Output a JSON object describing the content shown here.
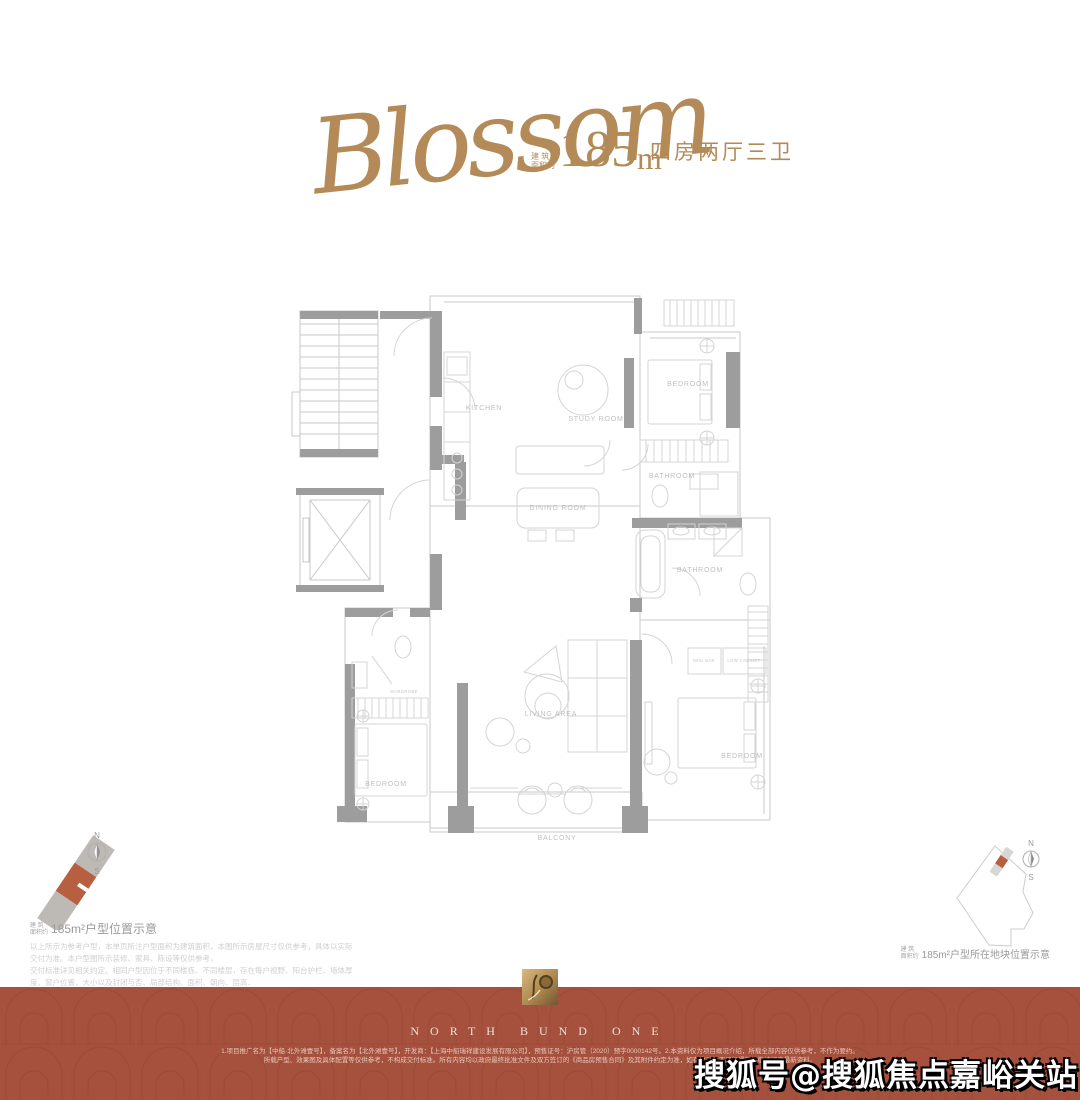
{
  "colors": {
    "gold": "#b28a55",
    "banner_red": "#a5513d",
    "terracotta": "#b65f41",
    "plan_wall": "#9d9d9d",
    "plan_line": "#c9c9c9",
    "label_gray": "#bfbfbf"
  },
  "header": {
    "script_name": "Blossom",
    "area_prefix_top": "建 筑",
    "area_prefix_bottom": "面积约",
    "area_value": "185",
    "area_unit": "m",
    "area_exponent": "2",
    "layout_text": "四房两厅三卫"
  },
  "floorplan": {
    "rooms": [
      {
        "label": "KITCHEN"
      },
      {
        "label": "STUDY ROOM"
      },
      {
        "label": "BEDROOM"
      },
      {
        "label": "BATHROOM"
      },
      {
        "label": "DINING ROOM"
      },
      {
        "label": "BATHROOM"
      },
      {
        "label": "LIVING AREA"
      },
      {
        "label": "BEDROOM"
      },
      {
        "label": "BEDROOM"
      },
      {
        "label": "BALCONY"
      },
      {
        "label": "MINI BAR"
      },
      {
        "label": "LOW CABINET"
      },
      {
        "label": "WARDROBE"
      }
    ]
  },
  "left_diagram": {
    "prefix_top": "建 筑",
    "prefix_bottom": "面积约",
    "caption": "185m²户型位置示意",
    "compass": {
      "north": "N",
      "south": "S"
    }
  },
  "right_diagram": {
    "prefix_top": "建 筑",
    "prefix_bottom": "面积约",
    "caption": "185m²户型所在地块位置示意",
    "compass": {
      "north": "N",
      "south": "S"
    }
  },
  "disclaimer_lines": [
    "以上所示为参考户型，本单页所注户型面积为建筑面积，本图所示房屋尺寸仅供参考，具体以实际交付为准。本户型图所示装修、家具、陈设等仅供参考，",
    "交付标准详见相关约定。相同户型因位于不同楼栋、不同楼层，存在每户视野、阳台护栏、墙体厚度、窗户位置、大小以及封闭与否、局部结构、面积、朝向、层高、",
    "管道等差异，可能存在差异，具体以双方签署的合同及实际交付为准。本资料所有图例及细节均以政府最终批准文件及双方签署的合同及实际交付为准。"
  ],
  "footer": {
    "brand_name": "NORTH BUND ONE",
    "fine_print_line1": "1.项目推广名为【中船·北外滩壹号】，备案名为【北外滩壹号】，开发商：【上海中船瑞祥建设发展有限公司】，预售证号：沪房管（2020）预字0000142号。2.本资料仅为项目概况介绍，所载全部内容仅供参考，不作为要约。",
    "fine_print_line2": "所载户型、效果图及具体配置等仅供参考，不构成交付标准。所有内容均以政府最终批准文件及双方签订的《商品房预售合同》及其附件约定为准，如有变动恕不另行通知，敬请留意最新资料。",
    "watermark": "搜狐号@搜狐焦点嘉峪关站"
  }
}
